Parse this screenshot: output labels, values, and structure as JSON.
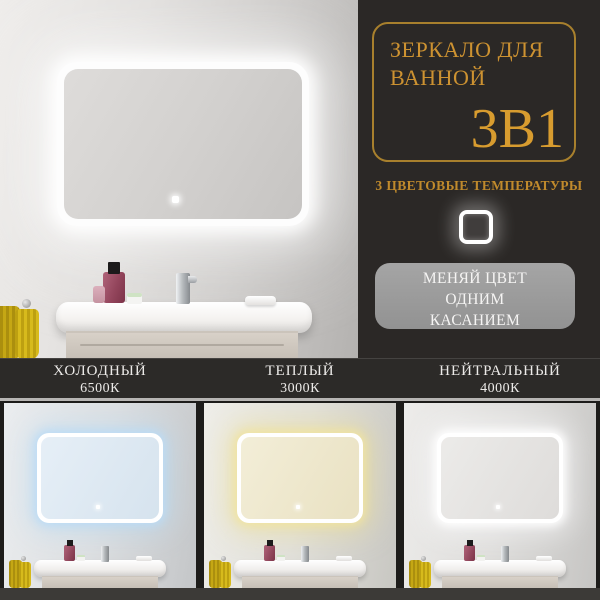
{
  "panel": {
    "title_line1": "ЗЕРКАЛО ДЛЯ",
    "title_line2": "ВАННОЙ",
    "badge": "3В1",
    "subtitle": "3 ЦВЕТОВЫЕ ТЕМПЕРАТУРЫ",
    "info_lines": [
      "МЕНЯЙ ЦВЕТ",
      "ОДНИМ",
      "КАСАНИЕМ"
    ]
  },
  "modes": [
    {
      "name": "ХОЛОДНЫЙ",
      "temp": "6500К"
    },
    {
      "name": "ТЕПЛЫЙ",
      "temp": "3000К"
    },
    {
      "name": "НЕЙТРАЛЬНЫЙ",
      "temp": "4000К"
    }
  ],
  "icons": {
    "touch_button": "touch-sensor-square-icon",
    "mirror_sensor": "mirror-touch-sensor-icon"
  },
  "colors": {
    "accent_gold": "#d0952e",
    "panel_bg": "#2b2826",
    "bar_bg": "#2c2a28",
    "info_box_bg": "#9b9b9b",
    "cold_glow": "#badbf5",
    "warm_glow": "#f0e4a0",
    "neutral_glow": "#ffffff",
    "towel_yellow": "#c5a714"
  }
}
